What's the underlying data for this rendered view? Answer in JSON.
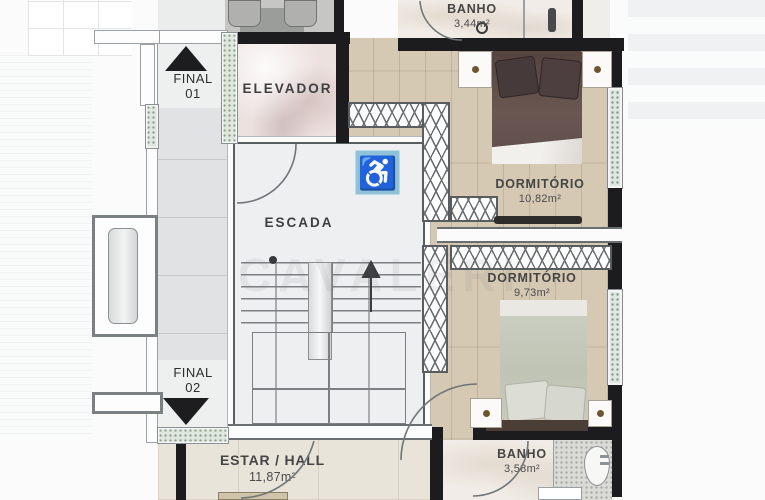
{
  "rooms": {
    "elevator": {
      "label": "ELEVADOR"
    },
    "stairs": {
      "label": "ESCADA"
    },
    "bath_top": {
      "label": "BANHO",
      "area": "3,44m²"
    },
    "bedroom_1": {
      "label": "DORMITÓRIO",
      "area": "10,82m²"
    },
    "bedroom_2": {
      "label": "DORMITÓRIO",
      "area": "9,73m²"
    },
    "bath_bottom": {
      "label": "BANHO",
      "area": "3,58m²"
    },
    "living_hall": {
      "label": "ESTAR / HALL",
      "area": "11,87m²"
    }
  },
  "units": {
    "final_01": {
      "line1": "FINAL",
      "line2": "01",
      "arrow": "up"
    },
    "final_02": {
      "line1": "FINAL",
      "line2": "02",
      "arrow": "down"
    }
  },
  "icons": {
    "accessibility": "♿",
    "stairs_direction": "up"
  },
  "watermark": "CAVALERI",
  "colors": {
    "wall": "#1c1c1e",
    "accessibility_blue": "#8fc2d8",
    "wood_floor": "#d5c9b4",
    "threshold_granite": "#dfe7df",
    "bed1_blanket": "#5f4d4a",
    "bed2_blanket": "#c6cabb"
  }
}
